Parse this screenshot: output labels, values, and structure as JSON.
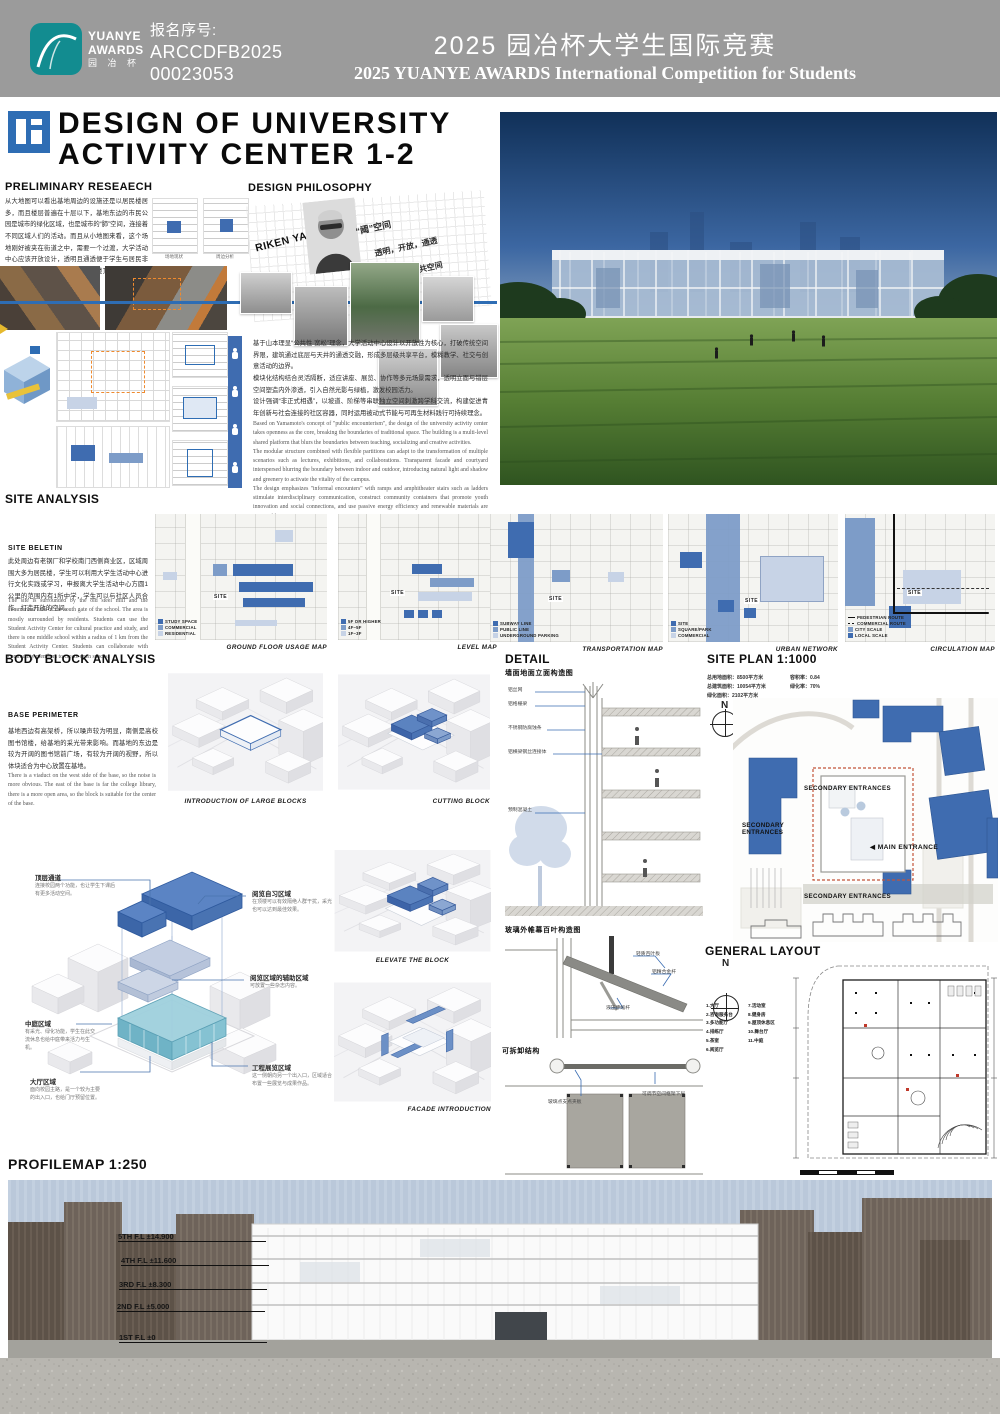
{
  "header": {
    "reg_label": "报名序号:",
    "reg_line1": "ARCCDFB2025",
    "reg_line2": "00023053",
    "logo_line1": "YUANYE",
    "logo_line2": "AWARDS",
    "logo_line3": "园 冶 杯",
    "title_cn": "2025 园冶杯大学生国际竞赛",
    "title_en": "2025 YUANYE AWARDS International Competition for  Students"
  },
  "title_block": {
    "line1": "DESIGN OF UNIVERSITY",
    "line2": "ACTIVITY CENTER 1-2"
  },
  "preliminary": {
    "heading": "PRELIMINARY RESEAECH",
    "paragraph": "从大地图可以看出基地周边的设施还是以居民楼居多，而且楼层普遍在十层以下，基地东边的市民公园是城市的绿化区域，也是城市的“肺”空间，连接着不同区域人们的活动。而且从小地图来看，这个场地刚好被夹在街道之中，需要一个过渡，大学活动中心应该开放设计，透明且通透便于学生与居民非正式互动，功能布局内外渗透，楼顶平台开放且融合周边的社区联结。",
    "thumb_captions": [
      "场地现状",
      "周边分析"
    ]
  },
  "philosophy": {
    "heading": "DESIGN PHILOSOPHY",
    "architect": "RIKEN YAMAMOTO",
    "keywords": [
      "“阈”空间",
      "透明，开放，通透",
      "模糊公共空间"
    ],
    "paragraph_cn": "基于山本理显“公共性 宽松”理念，大学活动中心设计以开放性为核心，打破传统空间界限，建筑通过底层与天井的通透交融，形成多层级共享平台，模糊教学、社交与创意活动的边界。\n模块化结构结合灵活隔断，适应讲座、展览、协作等多元场景需求，透明立面与错层空间塑造内外渗透，引入自然光影与绿植，激发校园活力。\n设计强调“非正式相遇”，以坡道、阶梯等串联独立空间刺激跨学科交流，构建促进青年创新与社会连接的社区容器，同时运用被动式节能与可再生材料践行可持续理念。",
    "paragraph_en": "Based on Yamamoto's concept of \"public encounterism\", the design of the university activity center takes openness as the core, breaking the boundaries of traditional space. The building is a multi-level shared platform that blurs the boundaries between teaching, socializing and creative activities.\nThe modular structure combined with flexible partitions can adapt to the transformation of multiple scenarios such as lectures, exhibitions, and collaborations. Transparent facade and courtyard interspersed blurring the boundary between indoor and outdoor, introducing natural light and shadow and greenery to activate the vitality of the campus.\nThe design emphasizes \"informal encounters\" with ramps and amphitheater stairs such as ladders stimulate interdisciplinary communication, construct community containers that promote youth innovation and social connections, and use passive energy efficiency and renewable materials are sustainable."
  },
  "site_analysis": {
    "heading": "SITE ANALYSIS",
    "subheading": "SITE BELETIN",
    "paragraph_cn": "此处周边有老钢厂和学校南门西侧商业区，区域周围大多为居民楼，学生可以利用大学生活动中心进行文化实践或学习，申报离大学生活动中心方圆1公里的范围内有1所中学，学生可以与社区人员合作，打造开放的空间。",
    "paragraph_en": "The site is surrounded by the old steel mill and the commercial area of the south gate of the school. The area is mostly surrounded by residents. Students can use the Student Activity Center for cultural practice and study, and there is one middle school within a radius of 1 km from the Student Activity Center. Students can collaborate with community members to create open spaces.",
    "site_label": "SITE",
    "maps": [
      {
        "caption": "GROUND FLOOR USAGE MAP",
        "legend": [
          {
            "label": "STUDY SPACE",
            "color": "#3f6cb0"
          },
          {
            "label": "COMMERCIAL",
            "color": "#7d9cc8"
          },
          {
            "label": "RESIDENTIAL",
            "color": "#c7d3e6"
          }
        ]
      },
      {
        "caption": "LEVEL MAP",
        "legend": [
          {
            "label": "5F OR HIGHER",
            "color": "#3f6cb0"
          },
          {
            "label": "4F~5F",
            "color": "#7d9cc8"
          },
          {
            "label": "1F~3F",
            "color": "#c7d3e6"
          }
        ]
      },
      {
        "caption": "TRANSPORTATION MAP",
        "legend": [
          {
            "label": "SUBWAY LINE",
            "color": "#3f6cb0"
          },
          {
            "label": "PUBLIC LINE",
            "color": "#7d9cc8"
          },
          {
            "label": "UNDERGROUND PARKING",
            "color": "#c7d3e6"
          }
        ]
      },
      {
        "caption": "URBAN NETWORK",
        "legend": [
          {
            "label": "SITE",
            "color": "#3f6cb0"
          },
          {
            "label": "SQUARE/PARK",
            "color": "#7d9cc8"
          },
          {
            "label": "COMMERCIAL",
            "color": "#c7d3e6"
          }
        ]
      },
      {
        "caption": "CIRCULATION MAP",
        "legend": [
          {
            "label": "PEDESTRIAN ROUTE",
            "color": "#111111"
          },
          {
            "label": "COMMERCIAL ROUTE",
            "color": "#111111"
          },
          {
            "label": "CITY SCALE",
            "color": "#7d9cc8"
          },
          {
            "label": "LOCAL SCALE",
            "color": "#3f6cb0"
          }
        ]
      }
    ]
  },
  "body_block": {
    "heading": "BODY BLOCK ANALYSIS",
    "subheading": "BASE PERIMETER",
    "paragraph_cn": "基地西边有高架桥，所以噪声较为明显，南侧是高校图书馆楼，给基地的采光带来影响。而基地的东边是较为开阔的图书馆前广场，有较为开阔的视野，所以体块适合为中心放置在基地。",
    "paragraph_en": "There is a viaduct on the west side of the base, so the noise is more obvious. The east of the base is far the college library, there is a more open area, so the block is suitable for the center of the base.",
    "captions": [
      "INTRODUCTION OF LARGE BLOCKS",
      "CUTTING BLOCK",
      "ELEVATE THE BLOCK",
      "FACADE INTRODUCTION"
    ],
    "callouts": [
      {
        "title": "顶层通道",
        "desc": "连接校园两个功能，也让学生下课后有更多活动空间。"
      },
      {
        "title": "阅览自习区域",
        "desc": "在顶楼可以有效隔绝人群干扰，采光也可以达到最佳效果。"
      },
      {
        "title": "阅览区域的辅助区域",
        "desc": "可放置一些杂志内容。"
      },
      {
        "title": "中庭区域",
        "desc": "有采光、绿化功能，学生在此交流休息也给中庭带来活力与生机。"
      },
      {
        "title": "大厅区域",
        "desc": "面向校园主路，是一个较为主要的出入口，也给门厅预留位置。"
      },
      {
        "title": "工程展览区域",
        "desc": "这一侧朝向另一个出入口，区域适合布置一些展览与成果作品。"
      }
    ]
  },
  "detail": {
    "heading": "DETAIL",
    "sub1": "墙面地面立面构造图",
    "wall_callouts": [
      "铝丝网",
      "铝格栅梁",
      "不锈钢防腐蚀条",
      "铝横梁钢丝连接体",
      "预制混凝土"
    ],
    "sub2": "玻璃外帷幕百叶构造图",
    "louver_callouts": [
      "轻质百叶板",
      "铝精合金杆",
      "液压伸缩杆"
    ],
    "sub3": "可拆卸结构",
    "removable_callouts": [
      "玻璃点支点夹板",
      "可调节空间框架下层"
    ]
  },
  "site_plan": {
    "heading": "SITE PLAN 1:1000",
    "stats_col1": [
      "总用地面积：8500平方米",
      "总建筑面积：10054平方米",
      "绿化面积：2102平方米"
    ],
    "stats_col2": [
      "容积率：0.84",
      "绿化率：70%"
    ],
    "north_label": "N",
    "labels": {
      "secondary_top": "SECONDARY ENTRANCES",
      "secondary_left": "SECONDARY ENTRANCES",
      "secondary_bottom": "SECONDARY ENTRANCES",
      "main": "MAIN ENTRANCE"
    }
  },
  "general_layout": {
    "heading": "GENERAL LAYOUT",
    "north_label": "N",
    "legend_col1": [
      "1.大厅",
      "2.咨询服务台",
      "3.多功能厅",
      "4.排练厅",
      "5.茶室",
      "6.阅览厅"
    ],
    "legend_col2": [
      "7.活动室",
      "8.健身房",
      "9.屋顶休息区",
      "10.舞台厅",
      "11.中庭"
    ]
  },
  "profile": {
    "heading": "PROFILEMAP 1:250",
    "levels": [
      "5TH F.L ±14.900",
      "4TH F.L ±11.600",
      "3RD F.L ±8.300",
      "2ND F.L ±5.000",
      "1ST F.L ±0"
    ]
  },
  "colors": {
    "accent_blue": "#3f6cb0",
    "mid_blue": "#7d9cc8",
    "light_blue": "#c7d3e6",
    "teal": "#128c90",
    "header_gray": "#9b9b9b"
  }
}
